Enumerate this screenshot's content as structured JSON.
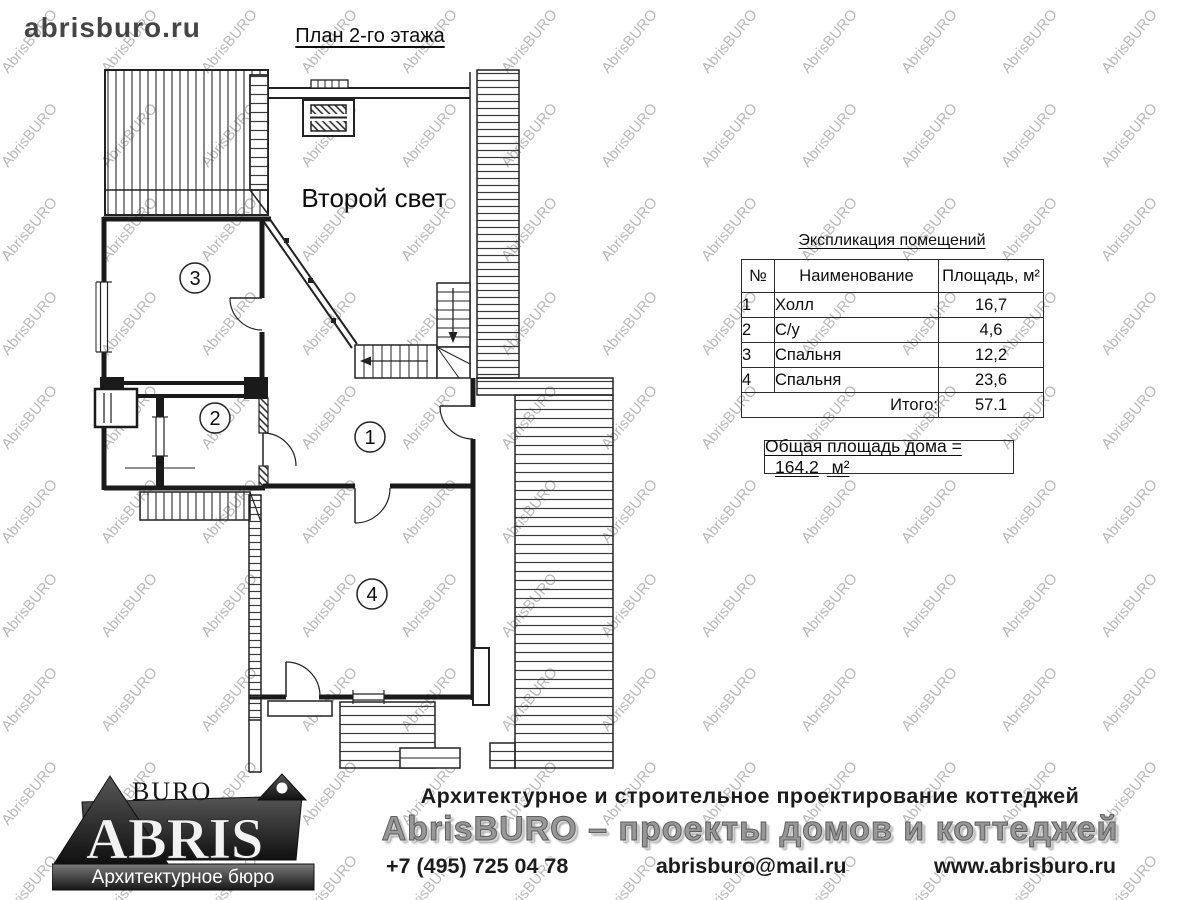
{
  "page": {
    "site": "abrisburo.ru",
    "title": "План 2-го этажа"
  },
  "watermark": {
    "text": "AbrisBURO"
  },
  "colors": {
    "watermark": "#b9b9b9",
    "line": "#222222",
    "wall": "#1a1a1a"
  },
  "plan": {
    "second_light": "Второй свет",
    "room_labels": [
      "1",
      "2",
      "3",
      "4"
    ]
  },
  "table": {
    "title": "Экспликация помещений",
    "headers": {
      "num": "№",
      "name": "Наименование",
      "area": "Площадь, м²"
    },
    "rows": [
      {
        "num": "1",
        "name": "Холл",
        "area": "16,7"
      },
      {
        "num": "2",
        "name": "С/у",
        "area": "4,6"
      },
      {
        "num": "3",
        "name": "Спальня",
        "area": "12,2"
      },
      {
        "num": "4",
        "name": "Спальня",
        "area": "23,6"
      }
    ],
    "total_label": "Итого:",
    "total_value": "57.1"
  },
  "summary": {
    "label": "Общая площадь дома =",
    "value": "164.2",
    "unit": "м²"
  },
  "footer": {
    "logo": {
      "top": "BURO",
      "main": "ABRIS",
      "sub": "Архитектурное бюро"
    },
    "tagline": "Архитектурное и строительное проектирование коттеджей",
    "brand_line": "AbrisBURO – проекты домов и коттеджей",
    "phone": "+7 (495) 725 04 78",
    "email": "abrisburo@mail.ru",
    "website": "www.abrisburo.ru"
  }
}
